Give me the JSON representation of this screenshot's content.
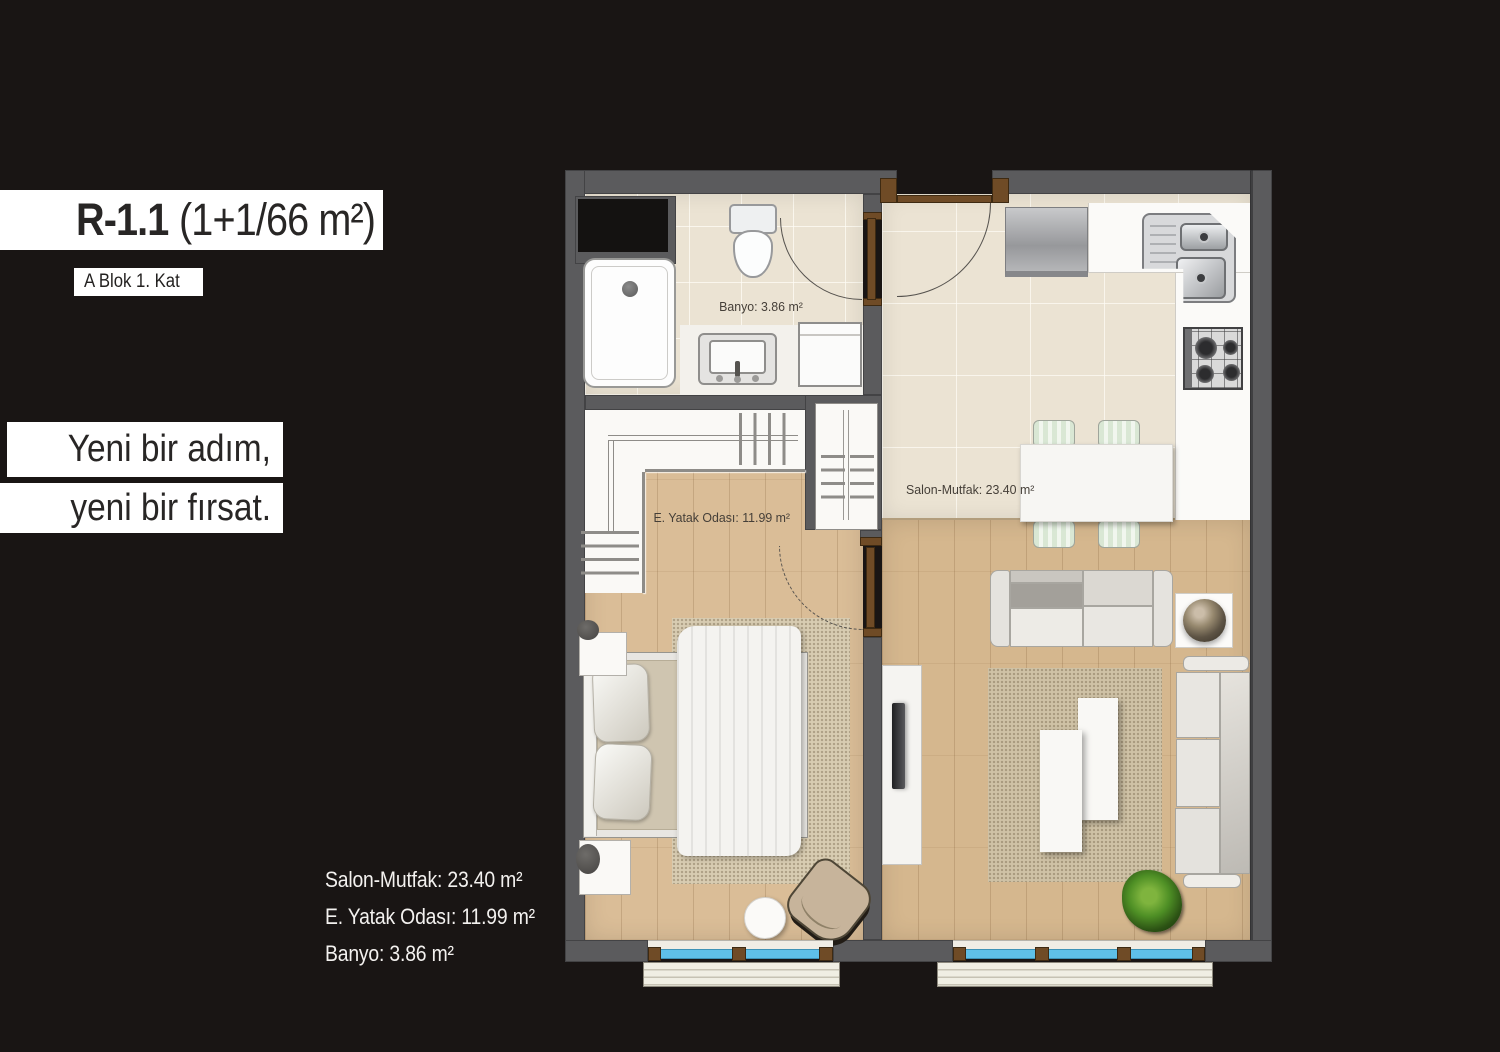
{
  "header": {
    "title_code": "R-1.1",
    "title_area": "(1+1/66 m²)",
    "subtitle": "A Blok 1. Kat"
  },
  "tagline": {
    "line1": "Yeni bir adım,",
    "line2": "yeni bir fırsat."
  },
  "area_list": [
    "Salon-Mutfak: 23.40 m²",
    "E. Yatak Odası: 11.99 m²",
    "Banyo: 3.86 m²"
  ],
  "plan": {
    "room_labels": {
      "banyo": "Banyo: 3.86 m²",
      "salon": "Salon-Mutfak: 23.40 m²",
      "yatak": "E. Yatak Odası: 11.99 m²"
    },
    "colors": {
      "wall": "#5b5b5d",
      "tile": "#ebe3d3",
      "wood": "#d5b78e",
      "window_glass": "#5fc0e8",
      "door_frame": "#6f4b26",
      "background": "#191514"
    }
  }
}
